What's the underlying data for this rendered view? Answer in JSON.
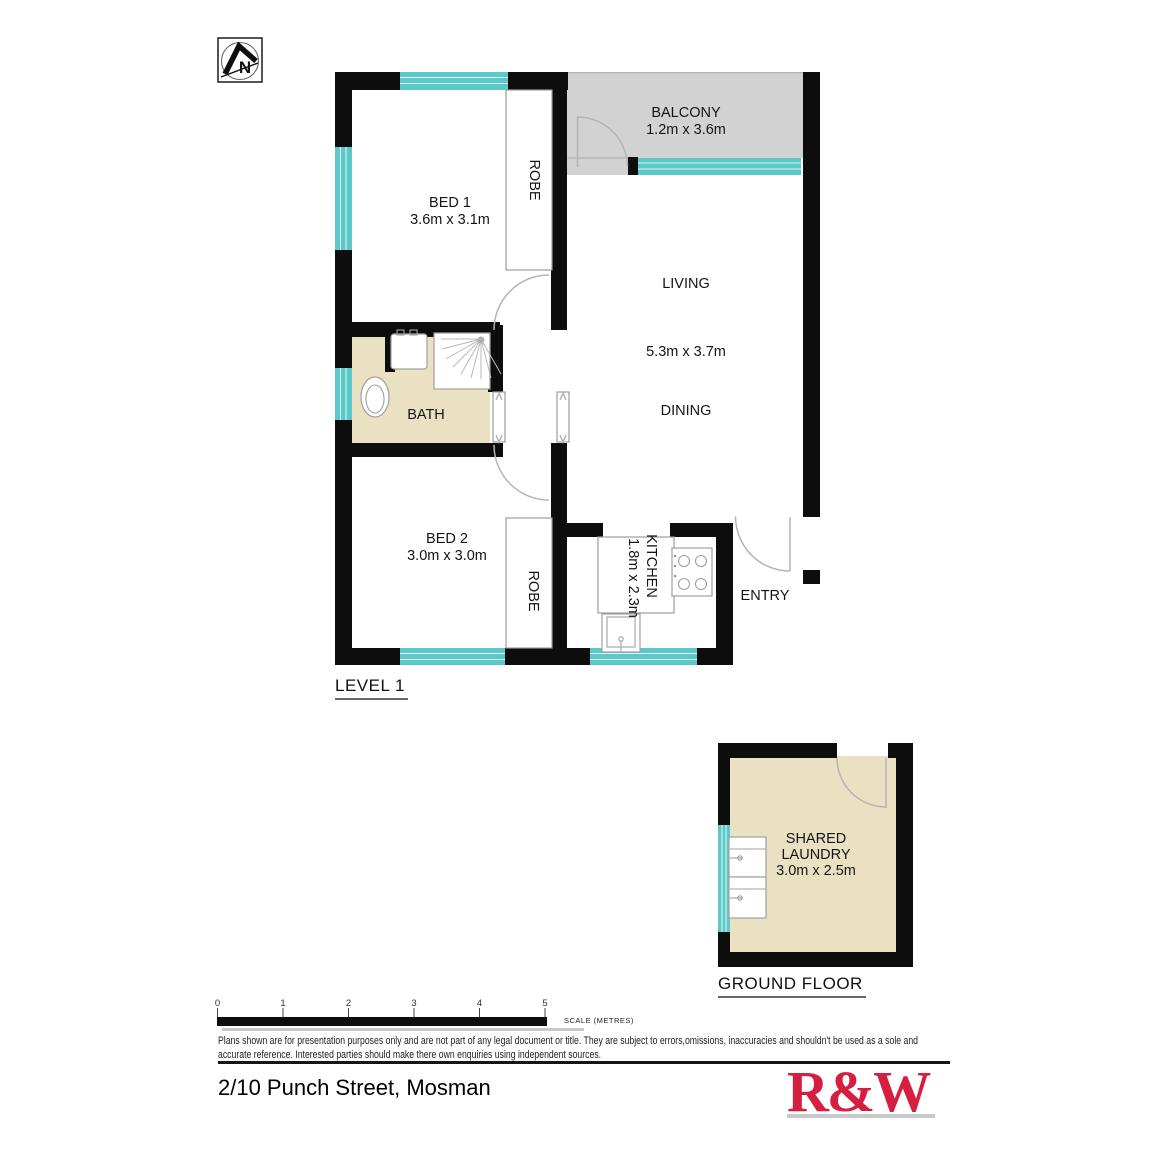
{
  "labels": {
    "north": "N",
    "bed1": "BED 1",
    "bed1_dims": "3.6m x 3.1m",
    "robe1": "ROBE",
    "balcony": "BALCONY",
    "balcony_dims": "1.2m x 3.6m",
    "living": "LIVING",
    "living_dims": "5.3m x 3.7m",
    "dining": "DINING",
    "bath": "BATH",
    "bed2": "BED 2",
    "bed2_dims": "3.0m x 3.0m",
    "robe2": "ROBE",
    "kitchen": "KITCHEN",
    "kitchen_dims": "1.8m x 2.3m",
    "entry": "ENTRY",
    "laundry_line1": "SHARED",
    "laundry_line2": "LAUNDRY",
    "laundry_dims": "3.0m x 2.5m",
    "level1_title": "LEVEL 1",
    "ground_title": "GROUND FLOOR"
  },
  "scale": {
    "ticks": [
      "0",
      "1",
      "2",
      "3",
      "4",
      "5"
    ],
    "label": "SCALE (METRES)"
  },
  "disclaimer": {
    "line1": "Plans shown are for presentation purposes only and are not part of any legal document or title. They are subject to errors,omissions, inaccuracies and shouldn't be used as a sole and",
    "line2": "accurate reference. Interested parties should make there own enquiries using independent sources."
  },
  "footer": {
    "address": "2/10 Punch Street, Mosman",
    "logo_text": "R&W"
  },
  "colors": {
    "wall": "#0d0d0d",
    "window_teal": "#5bc9c9",
    "balcony_grey": "#d2d2d2",
    "tile_beige": "#eae1c3",
    "logo_red": "#d61e41",
    "shadow_grey": "#c9c9c9"
  }
}
